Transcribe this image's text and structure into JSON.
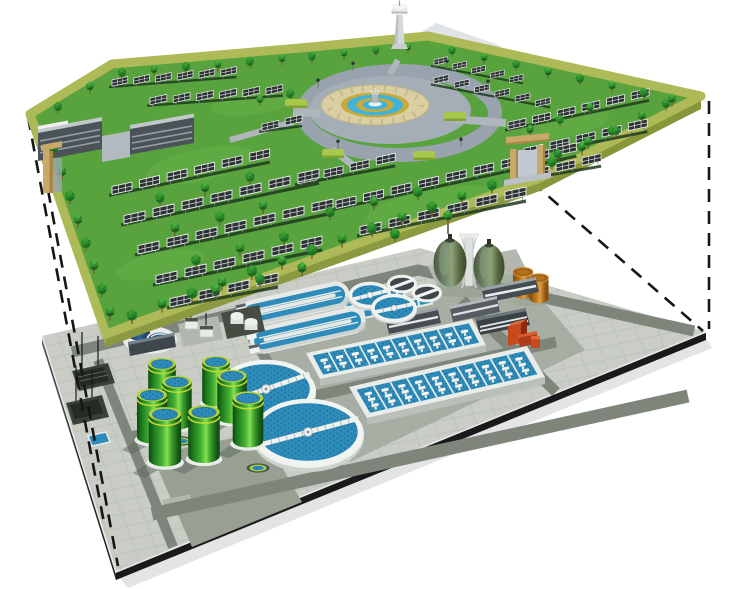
{
  "meta": {
    "title": "Cutaway illustration: solar park built above an underground wastewater treatment plant",
    "description": "Upper level: green park platform with rows of solar panels, trees, two office buildings, two tan entrance gates, an observation tower and a circular fountain plaza. Lower level: grey paved treatment plant platform with eight green digester tanks, two large secondary clarifiers, two oxidation ditches, two aeration basin blocks, two egg-shaped digesters, two orange storage tanks, service buildings and a red pump unit. Dashed black projection lines link the corners of the two levels."
  },
  "palette": {
    "background": "#ffffff",
    "park_grass": "#58a33d",
    "park_grass_light": "#6db64e",
    "park_border": "#aeb957",
    "park_side": "#9aab48",
    "tree_dark": "#1d6f21",
    "tree_light": "#3b9c35",
    "panel_cell": "#2c3134",
    "panel_frame": "#eceeee",
    "ring_road": "#99a3ad",
    "moat": "#a4aeb6",
    "plaza_tan": "#d9cfa3",
    "plaza_gold": "#c9a93e",
    "fountain_water": "#3fb4d8",
    "hedge": "#a7c84b",
    "building_body": "#4b5258",
    "gate_tan": "#c9a96a",
    "pavement": "#c9cdc6",
    "road": "#7e867b",
    "water": "#2d8cba",
    "water_dot": "#216f98",
    "digester_green": "#2f9e28",
    "digester_rim": "#b9d23c",
    "clarifier_wall": "#eef1ee",
    "egg_green": "#6b8268",
    "orange_tank": "#c07a1e",
    "navy_tank": "#27496e",
    "red_unit": "#c64a1e",
    "platform_side_dark": "#1a1a1c",
    "dash_line": "#161616"
  },
  "scene": {
    "park": {
      "label": "solar park ground level",
      "solar_rows": [
        [
          112,
          78,
          6,
          0.75,
          -2
        ],
        [
          150,
          96,
          6,
          0.8,
          -2
        ],
        [
          434,
          58,
          5,
          0.65,
          4.4
        ],
        [
          434,
          76,
          6,
          0.7,
          4.6
        ],
        [
          262,
          122,
          2,
          0.8,
          -5.6
        ],
        [
          508,
          120,
          6,
          0.85,
          -5.95
        ],
        [
          524,
          146,
          5,
          0.9,
          -6.3
        ],
        [
          530,
          168,
          3,
          0.9,
          -6.3
        ],
        [
          298,
          174,
          4,
          0.9,
          -6.3
        ],
        [
          336,
          198,
          9,
          0.95,
          -6.65
        ],
        [
          360,
          224,
          6,
          1,
          -7
        ],
        [
          112,
          184,
          6,
          0.95,
          -6.65
        ],
        [
          124,
          213,
          7,
          1,
          -7
        ],
        [
          138,
          243,
          7,
          1,
          -7
        ],
        [
          156,
          273,
          6,
          1,
          -7
        ],
        [
          170,
          296,
          4,
          1,
          -7
        ]
      ],
      "trees": [
        [
          58,
          105,
          0.7,
          1
        ],
        [
          90,
          85,
          0.7,
          2
        ],
        [
          122,
          71,
          0.7,
          1
        ],
        [
          154,
          68,
          0.65,
          2
        ],
        [
          186,
          65,
          0.7,
          1
        ],
        [
          218,
          63,
          0.65,
          2
        ],
        [
          250,
          60,
          0.7,
          1
        ],
        [
          282,
          57,
          0.65,
          2
        ],
        [
          312,
          55,
          0.65,
          1
        ],
        [
          344,
          52,
          0.6,
          2
        ],
        [
          376,
          49,
          0.6,
          1
        ],
        [
          408,
          46,
          0.6,
          2
        ],
        [
          452,
          49,
          0.65,
          1
        ],
        [
          484,
          56,
          0.65,
          2
        ],
        [
          516,
          63,
          0.65,
          1
        ],
        [
          548,
          70,
          0.7,
          2
        ],
        [
          580,
          77,
          0.7,
          1
        ],
        [
          612,
          84,
          0.7,
          2
        ],
        [
          644,
          91,
          0.75,
          1
        ],
        [
          672,
          97,
          0.75,
          2
        ],
        [
          132,
          313,
          0.9,
          1
        ],
        [
          162,
          302,
          0.85,
          2
        ],
        [
          192,
          291,
          0.9,
          1
        ],
        [
          222,
          280,
          0.85,
          2
        ],
        [
          252,
          269,
          0.9,
          1
        ],
        [
          282,
          259,
          0.85,
          2
        ],
        [
          312,
          248,
          0.9,
          1
        ],
        [
          342,
          237,
          0.85,
          2
        ],
        [
          372,
          226,
          0.9,
          1
        ],
        [
          402,
          215,
          0.85,
          2
        ],
        [
          432,
          205,
          0.9,
          1
        ],
        [
          462,
          194,
          0.85,
          2
        ],
        [
          492,
          183,
          0.85,
          1
        ],
        [
          552,
          160,
          0.8,
          1
        ],
        [
          582,
          145,
          0.8,
          2
        ],
        [
          612,
          129,
          0.75,
          1
        ],
        [
          642,
          114,
          0.75,
          2
        ],
        [
          666,
          102,
          0.7,
          1
        ],
        [
          54,
          146,
          0.8,
          1
        ],
        [
          62,
          170,
          0.8,
          2
        ],
        [
          70,
          194,
          0.85,
          1
        ],
        [
          78,
          218,
          0.8,
          2
        ],
        [
          86,
          241,
          0.85,
          1
        ],
        [
          94,
          264,
          0.8,
          2
        ],
        [
          102,
          287,
          0.85,
          1
        ],
        [
          110,
          310,
          0.85,
          2
        ],
        [
          160,
          196,
          0.8,
          1
        ],
        [
          205,
          186,
          0.8,
          2
        ],
        [
          250,
          175,
          0.8,
          1
        ],
        [
          175,
          226,
          0.85,
          2
        ],
        [
          220,
          215,
          0.85,
          1
        ],
        [
          263,
          204,
          0.8,
          2
        ],
        [
          196,
          258,
          0.85,
          1
        ],
        [
          240,
          246,
          0.85,
          2
        ],
        [
          284,
          235,
          0.85,
          1
        ],
        [
          216,
          288,
          0.9,
          2
        ],
        [
          260,
          277,
          0.85,
          1
        ],
        [
          302,
          266,
          0.85,
          2
        ],
        [
          330,
          210,
          0.85,
          1
        ],
        [
          374,
          200,
          0.8,
          2
        ],
        [
          418,
          190,
          0.85,
          1
        ],
        [
          395,
          232,
          0.85,
          1
        ],
        [
          448,
          214,
          0.85,
          2
        ],
        [
          530,
          128,
          0.7,
          2
        ],
        [
          560,
          118,
          0.7,
          1
        ],
        [
          590,
          106,
          0.7,
          2
        ],
        [
          558,
          152,
          0.75,
          1
        ],
        [
          588,
          140,
          0.75,
          2
        ],
        [
          616,
          129,
          0.7,
          1
        ],
        [
          290,
          92,
          0.7,
          1
        ],
        [
          260,
          98,
          0.65,
          2
        ]
      ],
      "fountain": {
        "label": "circular fountain plaza with ring road and pond",
        "hedges": [
          [
            296,
            103
          ],
          [
            455,
            116
          ],
          [
            333,
            153
          ],
          [
            424,
            155
          ]
        ],
        "lamps": [
          [
            318,
            88
          ],
          [
            353,
            71
          ],
          [
            447,
            69
          ],
          [
            488,
            89
          ],
          [
            338,
            149
          ],
          [
            461,
            147
          ]
        ]
      },
      "buildings": {
        "count": 2,
        "label": "office buildings"
      },
      "gates": {
        "count": 2,
        "label": "tan entrance gates"
      },
      "tower": {
        "label": "white observation tower"
      }
    },
    "plant": {
      "label": "underground wastewater treatment plant level",
      "digester_tanks": {
        "count": 8,
        "positions": [
          [
            216,
            360,
            0.92
          ],
          [
            162,
            362,
            0.92
          ],
          [
            232,
            374,
            0.98
          ],
          [
            177,
            380,
            0.98
          ],
          [
            152,
            393,
            1
          ],
          [
            248,
            396,
            1.02
          ],
          [
            204,
            410,
            1.05
          ],
          [
            165,
            412,
            1.08
          ]
        ]
      },
      "clarifiers": [
        {
          "cx": 266,
          "cy": 389,
          "rx": 46,
          "ry": 27,
          "rot": -19,
          "bl": 46
        },
        {
          "cx": 308,
          "cy": 432,
          "rx": 52,
          "ry": 31,
          "rot": -15,
          "bl": 52
        }
      ],
      "aeration_basins": [
        {
          "x": 306,
          "y": 353,
          "ux": 166,
          "uy": -34,
          "vx": 14,
          "vy": 26,
          "lanes": 10,
          "aer": 2
        },
        {
          "x": 349,
          "y": 387,
          "ux": 178,
          "uy": -41,
          "vx": 18,
          "vy": 31,
          "lanes": 10,
          "aer": 3
        }
      ],
      "oxidation_ditches": {
        "count": 2
      },
      "egg_digesters": {
        "count": 2
      },
      "storage_tanks": {
        "count": 2,
        "color": "#c07a1e"
      },
      "intermediate_tanks": {
        "count": 2
      },
      "covered_tanks": {
        "count": 2
      },
      "service_buildings": {
        "count": 4
      },
      "inlet_units": {
        "count": 2
      },
      "ground_pools": {
        "count": 2
      }
    },
    "projection_lines": [
      [
        28,
        117,
        104,
        523
      ],
      [
        48,
        190,
        118,
        566
      ],
      [
        709,
        101,
        709,
        329
      ],
      [
        532,
        182,
        703,
        331
      ]
    ]
  }
}
